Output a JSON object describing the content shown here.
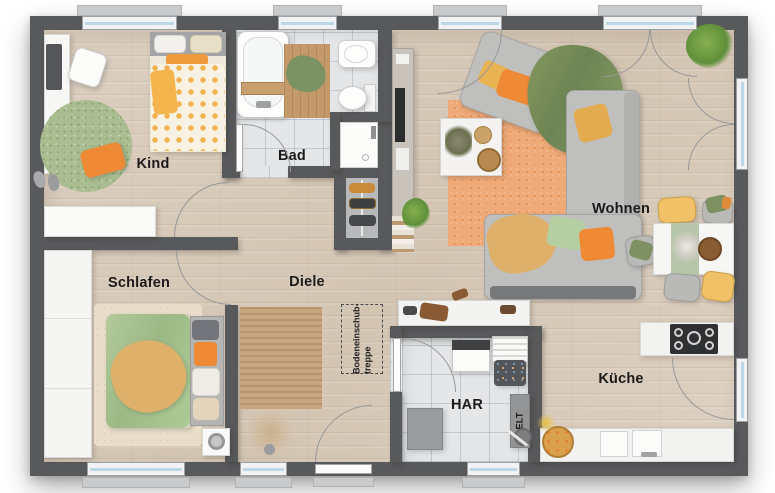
{
  "title": "Grundriss / floor plan",
  "colors": {
    "wall": "#58595b",
    "wood-floor": "#d8cab9",
    "tile-floor": "#e4e6e8",
    "glass": "#bcd7e6",
    "accent-orange": "#ee8936",
    "accent-yellow": "#eebd66",
    "accent-green": "#7c9161",
    "rug-green": "#a9bd90",
    "rug-orange": "#f0aa77",
    "rug-jute": "#c8a57f",
    "sofa-gray": "#bfbfbd"
  },
  "rooms": {
    "kind": {
      "label": "Kind"
    },
    "bad": {
      "label": "Bad"
    },
    "wohnen": {
      "label": "Wohnen"
    },
    "schlafen": {
      "label": "Schlafen"
    },
    "diele": {
      "label": "Diele"
    },
    "har": {
      "label": "HAR"
    },
    "kueche": {
      "label": "Küche"
    }
  },
  "annotations": {
    "attic_stairs": {
      "line1": "Bodeneinschub-",
      "line2": "treppe"
    },
    "electrical": {
      "label": "ELT"
    }
  },
  "openings": {
    "windows": [
      "kind-north",
      "bad-north",
      "wohnen-north-left",
      "wohnen-north-right",
      "schlafen-south",
      "diele-south",
      "har-south"
    ],
    "doors": [
      "entrance-south",
      "double-terrace-door-east",
      "kitchen-door-east",
      "kind-door",
      "schlafen-door",
      "bad-door",
      "har-door"
    ]
  },
  "furniture": {
    "kind": [
      "desk",
      "desk-chair",
      "single-bed",
      "round-rug",
      "floor-pillow",
      "shoes",
      "sideboard"
    ],
    "bad": [
      "bathtub",
      "bath-mat",
      "washbasin",
      "toilet",
      "shower"
    ],
    "wohnen": [
      "tv-sideboard",
      "armchair",
      "corner-sofa",
      "coffee-table",
      "area-rug",
      "throw-blanket",
      "plants",
      "dining-table",
      "dining-chairs"
    ],
    "schlafen": [
      "wardrobe",
      "double-bed",
      "area-rug",
      "nightstand-with-lamp"
    ],
    "diele": [
      "runner-rug",
      "dried-plant",
      "shoe-rack",
      "bench"
    ],
    "har": [
      "washing-machine",
      "drying-rack",
      "laundry-basket",
      "storage-box",
      "electrical-panel",
      "vacuum-cleaner"
    ],
    "kueche": [
      "cooktop-counter",
      "sink-counter",
      "fruit-basket"
    ]
  }
}
